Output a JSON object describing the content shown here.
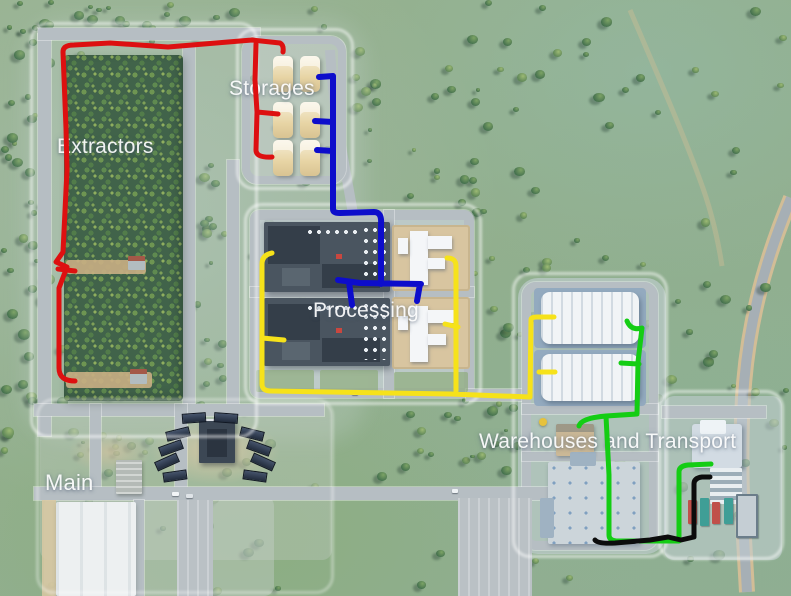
{
  "scene": {
    "title": "Forestry industry area overview map",
    "labels": [
      {
        "id": "extractors",
        "text": "Extractors",
        "x": 57,
        "y": 135,
        "size": 21
      },
      {
        "id": "storages",
        "text": "Storages",
        "x": 229,
        "y": 77,
        "size": 21
      },
      {
        "id": "processing",
        "text": "Processing",
        "x": 313,
        "y": 299,
        "size": 21
      },
      {
        "id": "warehouses-and-transport",
        "text": "Warehouses and Transport",
        "x": 479,
        "y": 430,
        "size": 21
      },
      {
        "id": "main",
        "text": "Main",
        "x": 45,
        "y": 470,
        "size": 22
      }
    ],
    "routes": [
      {
        "name": "red-extractor-route",
        "color": "#dd1010",
        "width": 5,
        "d": "M63,52 Q63,45 74,45 L110,43 L168,47 L252,40 L280,43 Q284,45 283,52 M63,52 L66,128 L67,170 L63,252 L56,262 L67,267 L59,288 L59,368 Q59,381 75,381 M58,269 L75,271 M256,44 L255,80 L257,112 L256,150 Q256,158 272,157 M257,112 L278,114"
      },
      {
        "name": "blue-storage-route",
        "color": "#0d0dcb",
        "width": 6,
        "d": "M319,77 L333,76 L333,209 Q333,213 340,213 L374,212 Q382,212 381,224 L381,284 M315,121 L333,122 M317,150 L333,151 M338,280 L360,283 L421,284 M349,282 L352,305 M420,284 L417,301"
      },
      {
        "name": "yellow-processing-route",
        "color": "#f6e21a",
        "width": 5,
        "d": "M272,253 Q262,255 262,264 L262,384 Q262,391 271,391 L450,394 L530,397 M262,338 L284,340 M447,258 Q456,258 456,266 L456,391 M445,324 L458,327 M530,397 L531,320 Q531,317 537,317 L554,317 M539,372 L555,372"
      },
      {
        "name": "green-warehouse-route",
        "color": "#14cd14",
        "width": 5,
        "d": "M627,321 Q631,331 642,328 L638,362 L637,414 L606,416 Q581,418 579,426 M621,363 L639,364 M606,416 L609,475 L609,535 Q609,541 618,541 L679,541 L679,472 Q679,466 688,465 L711,464"
      },
      {
        "name": "black-transport-route",
        "color": "#0c0c0c",
        "width": 5,
        "d": "M595,540 Q598,544 615,543 L650,540 L668,537 L681,540 L694,537 L694,484 Q694,478 702,477 L710,477"
      }
    ]
  }
}
